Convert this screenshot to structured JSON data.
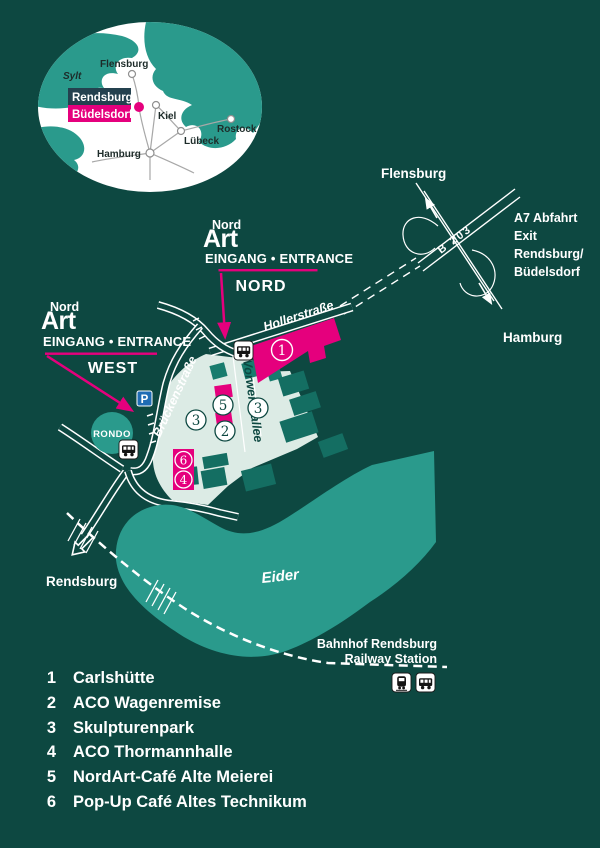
{
  "inset": {
    "cities": {
      "sylt": "Sylt",
      "flensburg": "Flensburg",
      "kiel": "Kiel",
      "luebeck": "Lübeck",
      "rostock": "Rostock",
      "hamburg": "Hamburg"
    },
    "highlight": {
      "line1": "Rendsburg",
      "line2": "Büdelsdorf"
    }
  },
  "logo": {
    "top": "Nord",
    "bottom": "Art"
  },
  "entrance_nord": {
    "title": "EINGANG • ENTRANCE",
    "subtitle": "NORD"
  },
  "entrance_west": {
    "title": "EINGANG • ENTRANCE",
    "subtitle": "WEST"
  },
  "streets": {
    "hollerstrasse": "Hollerstraße",
    "brueckenstrasse": "Brückenstraße",
    "vorwerksallee": "Vorwerksallee",
    "b203": "B 203"
  },
  "directions": {
    "flensburg": "Flensburg",
    "hamburg": "Hamburg",
    "rendsburg": "Rendsburg"
  },
  "a7_exit": {
    "line1": "A7 Abfahrt",
    "line2": "Exit",
    "line3": "Rendsburg/",
    "line4": "Büdelsdorf"
  },
  "station": {
    "line1": "Bahnhof Rendsburg",
    "line2": "Railway Station"
  },
  "river_label": "Eider",
  "rondo_label": "RONDO",
  "parking_label": "P",
  "markers": {
    "m1": "1",
    "m2": "2",
    "m3": "3",
    "m4": "4",
    "m5": "5",
    "m6": "6"
  },
  "legend": {
    "items": [
      {
        "num": "1",
        "label": "Carlshütte"
      },
      {
        "num": "2",
        "label": "ACO Wagenremise"
      },
      {
        "num": "3",
        "label": "Skulpturenpark"
      },
      {
        "num": "4",
        "label": "ACO Thormannhalle"
      },
      {
        "num": "5",
        "label": "NordArt-Café Alte Meierei"
      },
      {
        "num": "6",
        "label": "Pop-Up Café Altes Technikum"
      }
    ]
  },
  "colors": {
    "background": "#0d4841",
    "magenta": "#e5007d",
    "teal_bright": "#2a9a8c",
    "teal_building": "#187c6e",
    "pale_park": "#dcebe5",
    "parking_blue": "#1f6cb4",
    "badge_navy": "#24414f"
  }
}
